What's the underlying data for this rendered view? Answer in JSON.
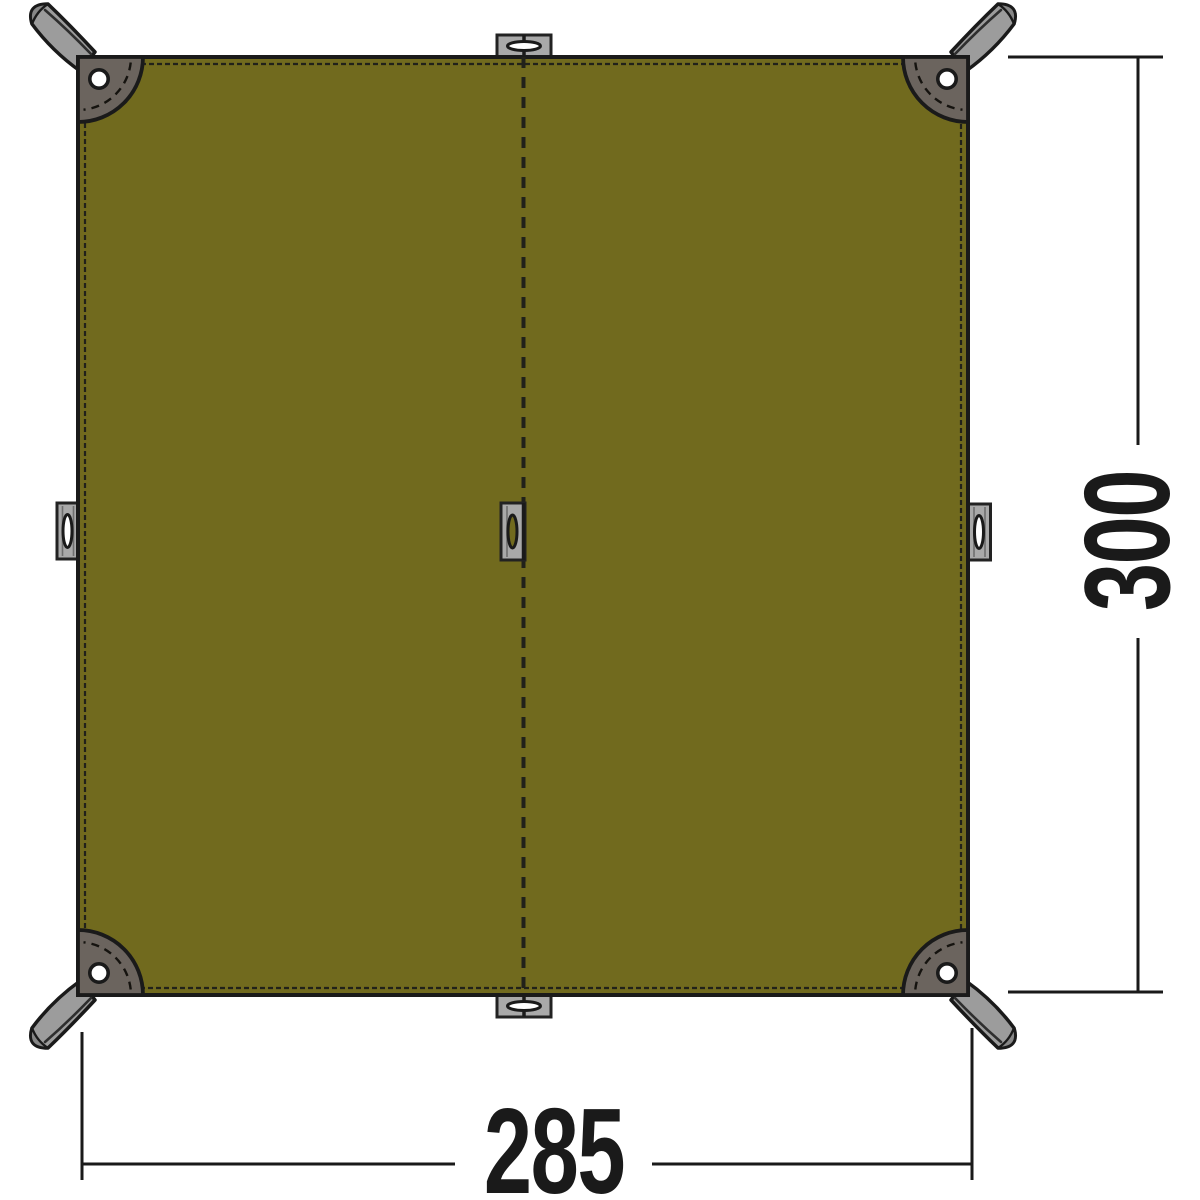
{
  "diagram": {
    "type": "product-top-view-technical-drawing",
    "subject": "rectangular olive tarp with corner webbing loops, edge loops and center seam",
    "dimensions": {
      "width_label": "285",
      "height_label": "300"
    },
    "parts": {
      "fabric_panel": "tarp fabric panel",
      "center_seam": "dashed center seam",
      "edge_stitching": "dashed hem stitching along all four edges",
      "corner_patches": [
        "top-left",
        "top-right",
        "bottom-left",
        "bottom-right"
      ],
      "grommets": [
        "top-left",
        "top-right",
        "bottom-left",
        "bottom-right"
      ],
      "corner_straps": [
        "top-left",
        "top-right",
        "bottom-left",
        "bottom-right"
      ],
      "edge_loops": [
        "left-middle",
        "right-middle",
        "top-center",
        "bottom-center",
        "center"
      ]
    },
    "colors": {
      "fabric": "#716A1E",
      "outline": "#1A1A1A",
      "stitch": "#21211A",
      "patch": "#6B645E",
      "webbing": "#9C9C9C",
      "webbing_dark": "#878787",
      "tab": "#A9A9A9",
      "background": "#FFFFFF",
      "dim": "#1A1A1A"
    }
  }
}
